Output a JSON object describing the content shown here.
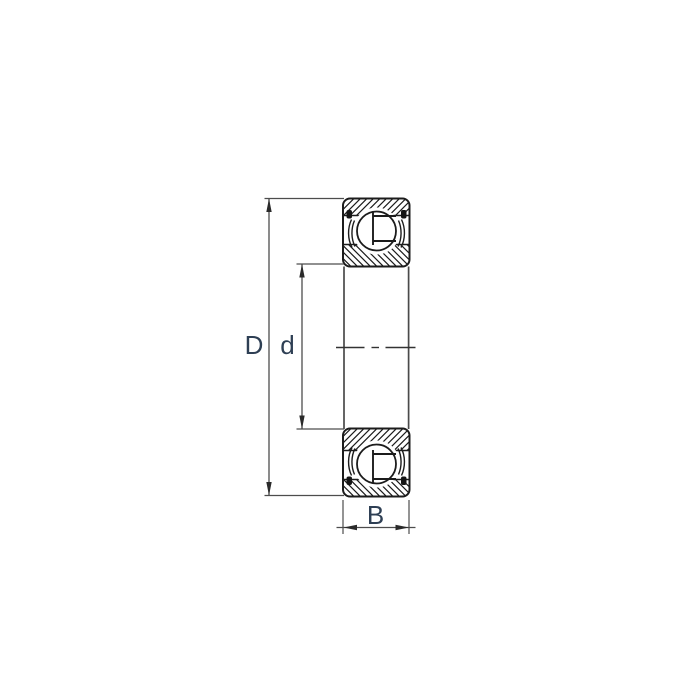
{
  "figure": {
    "name": "Deep groove ball bearing cross-section drawing with shields",
    "background": "#ffffff",
    "labels": {
      "outer_diameter": "D",
      "bore_diameter": "d",
      "width": "B"
    },
    "colors": {
      "outline": "#1c1c1c",
      "dimension_line": "#4d4d4d",
      "label_text": "#2e3f54"
    }
  }
}
